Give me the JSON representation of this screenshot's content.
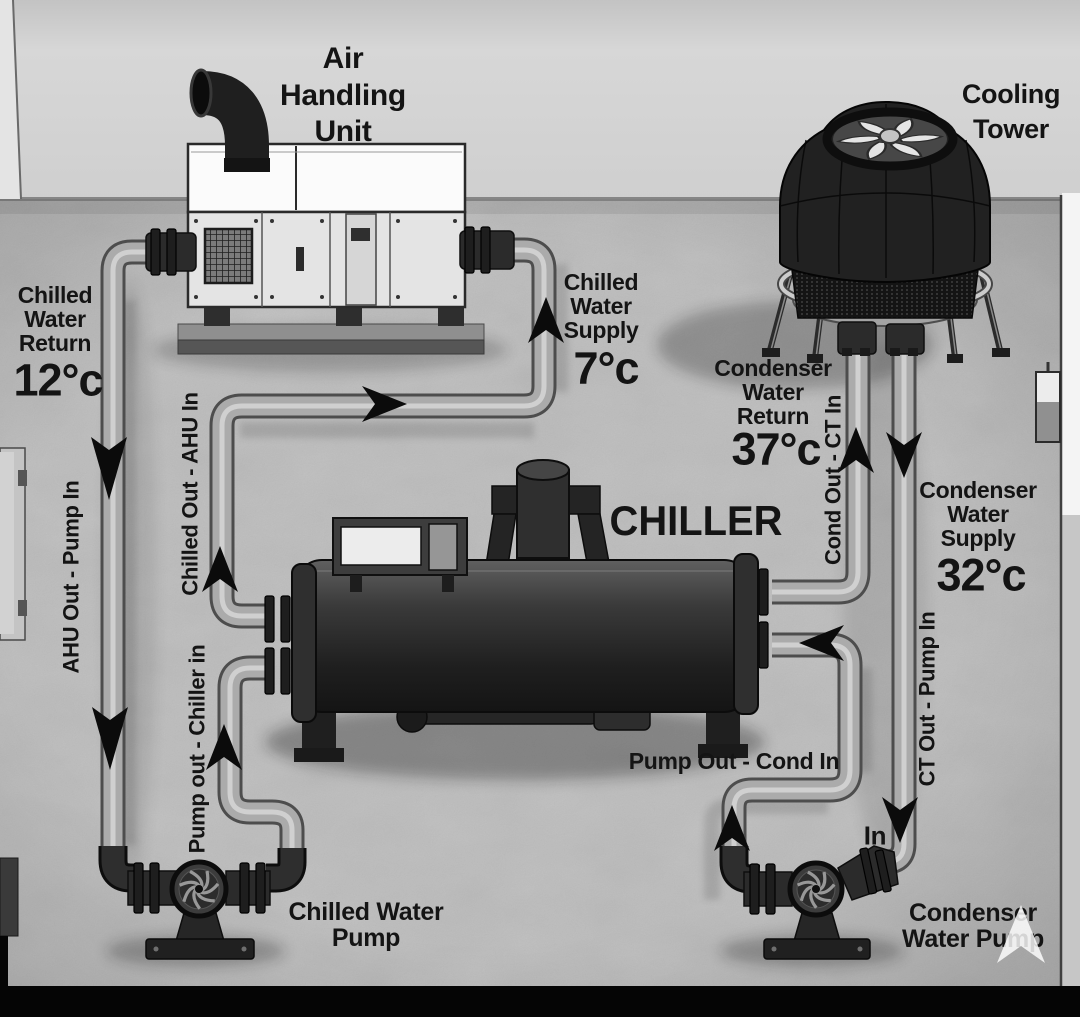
{
  "equipment": {
    "air_handling_unit": "Air Handling Unit",
    "cooling_tower": "Cooling Tower",
    "chiller": "CHILLER",
    "chilled_water_pump": "Chilled Water Pump",
    "condenser_water_pump": "Condenser Water Pump"
  },
  "flow_labels": {
    "chilled_water_return": {
      "name": "Chilled Water Return",
      "temp": "12°c"
    },
    "chilled_water_supply": {
      "name": "Chilled Water Supply",
      "temp": "7°c"
    },
    "condenser_water_return": {
      "name": "Condenser Water Return",
      "temp": "37°c"
    },
    "condenser_water_supply": {
      "name": "Condenser Water Supply",
      "temp": "32°c"
    }
  },
  "pipe_labels": {
    "ahu_out_pump_in": "AHU Out - Pump In",
    "chilled_out_ahu_in": "Chilled Out - AHU In",
    "pump_out_chiller_in": "Pump out - Chiller in",
    "cond_out_ct_in": "Cond Out - CT In",
    "ct_out_pump_in": "CT Out - Pump In",
    "pump_out_cond_in": "Pump Out - Cond In",
    "pump_inlet": "In"
  },
  "colors": {
    "wall": "#d3d3d3",
    "floor": "#bcbcbc",
    "pipe": "#ababab",
    "equipment_dark": "#1f1f1f",
    "text": "#141414"
  }
}
